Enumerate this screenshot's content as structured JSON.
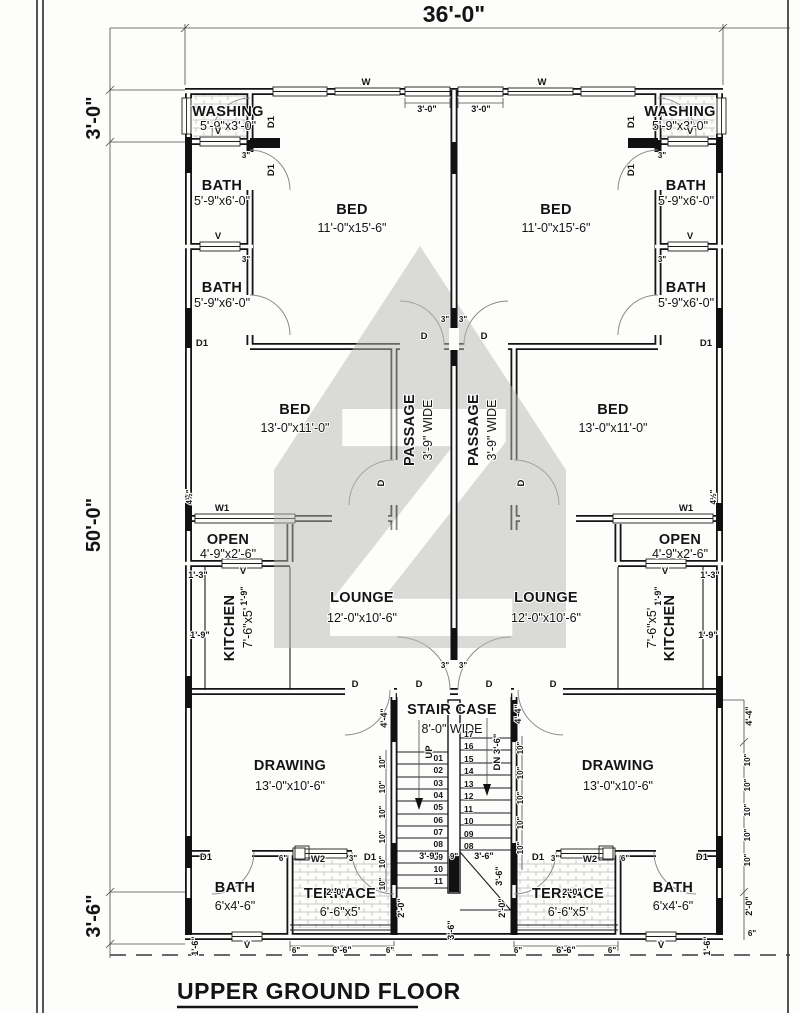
{
  "page": {
    "title": "UPPER GROUND FLOOR"
  },
  "overall_dims": {
    "width": "36'-0\"",
    "top_strip": "3'-0\"",
    "height": "50'-0\"",
    "bottom_strip": "3'-6\""
  },
  "rooms": {
    "washing": {
      "name": "WASHING",
      "size": "5'-9\"x3'-0\""
    },
    "bath": {
      "name": "BATH",
      "size": "5'-9\"x6'-0\""
    },
    "bed_master": {
      "name": "BED",
      "size": "11'-0\"x15'-6\""
    },
    "bed": {
      "name": "BED",
      "size": "13'-0\"x11'-0\""
    },
    "passage": {
      "name": "PASSAGE",
      "size": "3'-9\" WIDE"
    },
    "open": {
      "name": "OPEN",
      "size": "4'-9\"x2'-6\""
    },
    "kitchen": {
      "name": "KITCHEN",
      "size": "7'-6\"x5'"
    },
    "lounge": {
      "name": "LOUNGE",
      "size": "12'-0\"x10'-6\""
    },
    "drawing": {
      "name": "DRAWING",
      "size": "13'-0\"x10'-6\""
    },
    "stair": {
      "name": "STAIR CASE",
      "size": "8'-0\" WIDE"
    },
    "bath_small": {
      "name": "BATH",
      "size": "6'x4'-6\""
    },
    "terrace": {
      "name": "TERRACE",
      "size": "6'-6\"x5'"
    }
  },
  "openings": {
    "window": "W",
    "window1": "W1",
    "window2": "W2",
    "vent": "V",
    "door": "D",
    "door_alt": "D1"
  },
  "stairs": {
    "up": "UP",
    "down": "DN 3'-6\"",
    "steps_left": [
      "01",
      "02",
      "03",
      "04",
      "05",
      "06",
      "07",
      "08",
      "09",
      "10",
      "11"
    ],
    "steps_right": [
      "17",
      "16",
      "15",
      "14",
      "13",
      "12",
      "11",
      "10",
      "09",
      "08"
    ]
  },
  "dims": {
    "three_ft": "3'-0\"",
    "three_in": "3\"",
    "six_in": "6\"",
    "nine_in": "9\"",
    "ten_in": "10\"",
    "one_three": "1'-3\"",
    "one_six": "1'-6\"",
    "one_nine": "1'-9\"",
    "two_ft": "2'-0\"",
    "three_six": "3'-6\"",
    "three_nine": "3'-9\"",
    "four_four": "4'-4\"",
    "four_half": "4½\"",
    "six_six": "6'-6\""
  }
}
